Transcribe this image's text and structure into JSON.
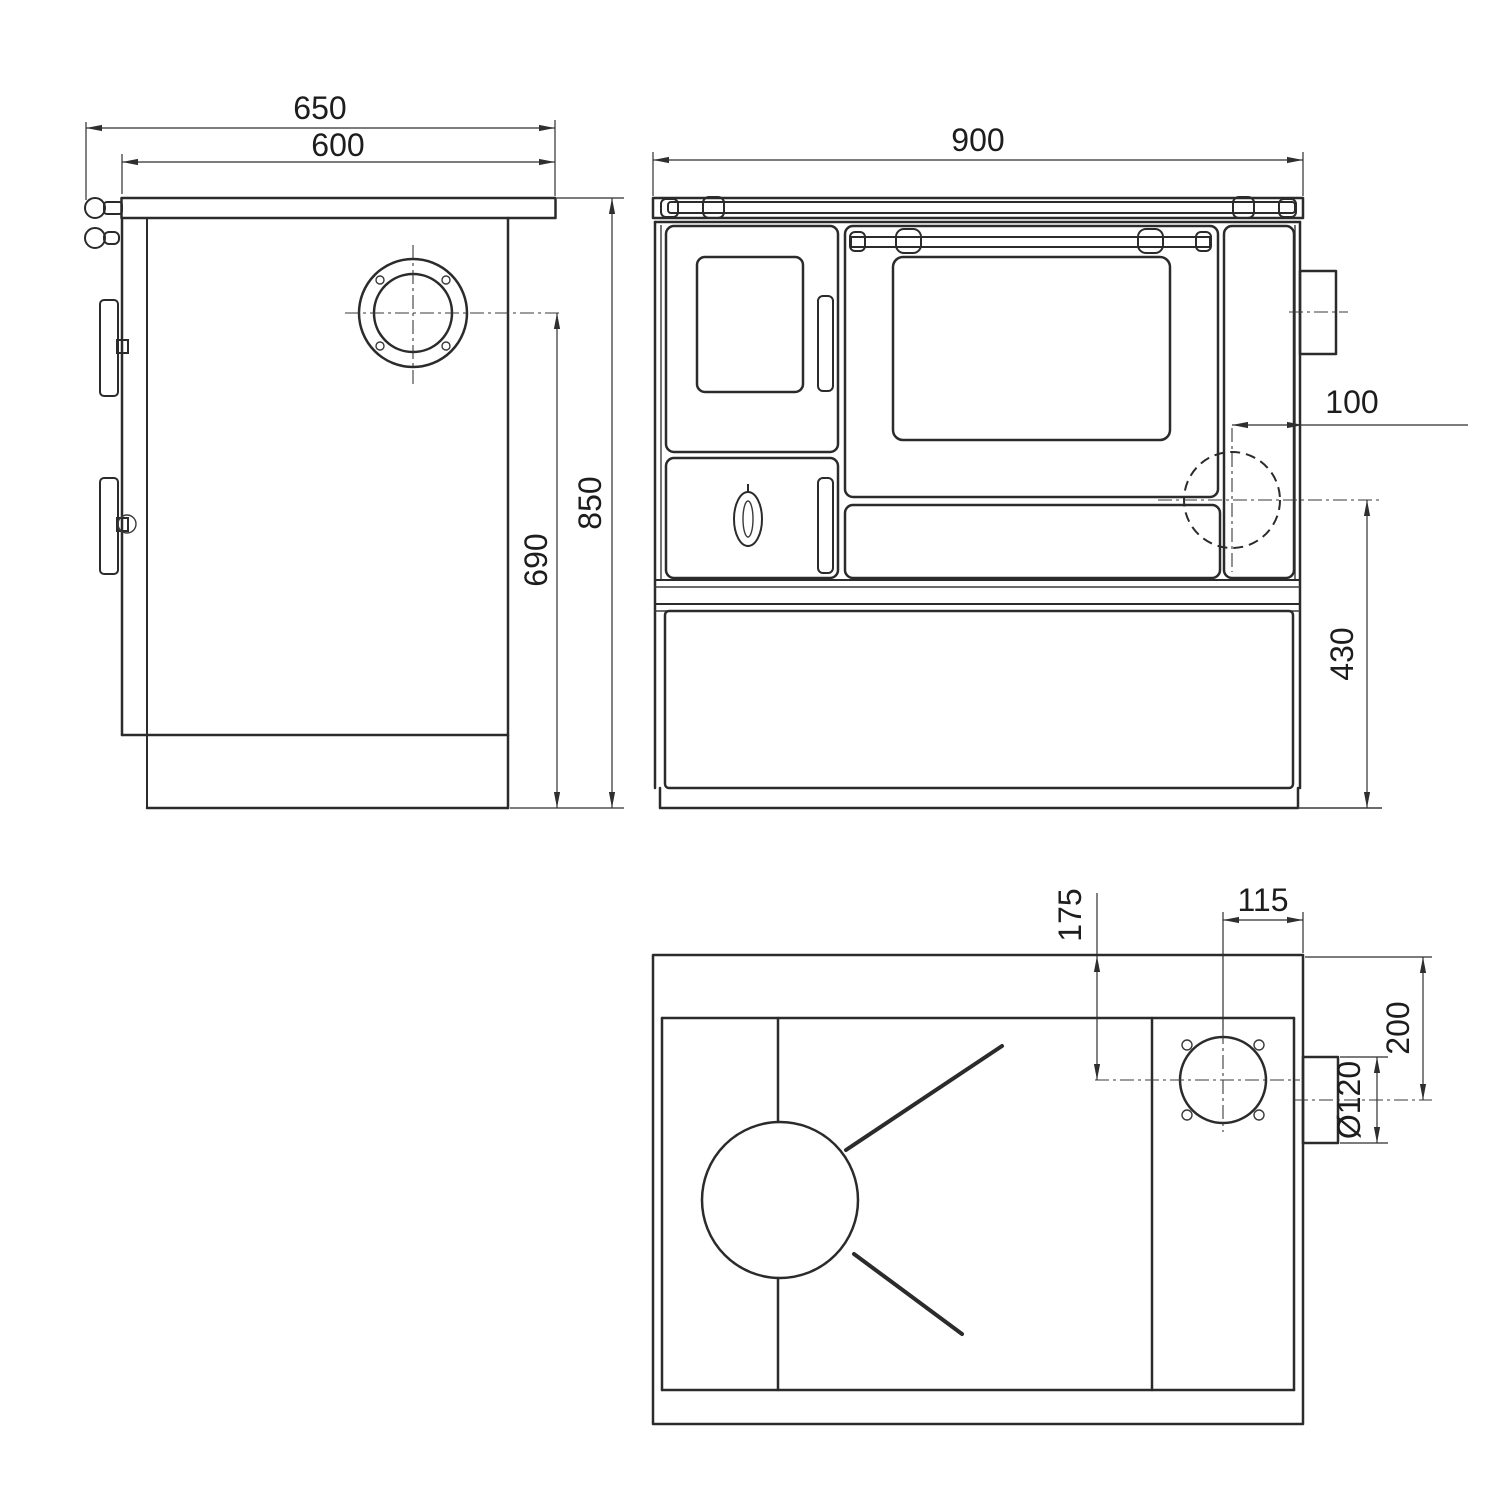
{
  "views": {
    "side": {
      "dims": {
        "overall_depth": "650",
        "worktop_depth": "600",
        "overall_height": "850",
        "flue_center_height": "690"
      }
    },
    "front": {
      "dims": {
        "overall_width": "900",
        "rear_flue_offset": "100",
        "side_flue_center_height": "430"
      }
    },
    "top": {
      "dims": {
        "flue_center_from_back": "175",
        "flue_center_from_right": "115",
        "stub_center_from_back": "200",
        "flue_diameter": "Ø120"
      }
    }
  }
}
